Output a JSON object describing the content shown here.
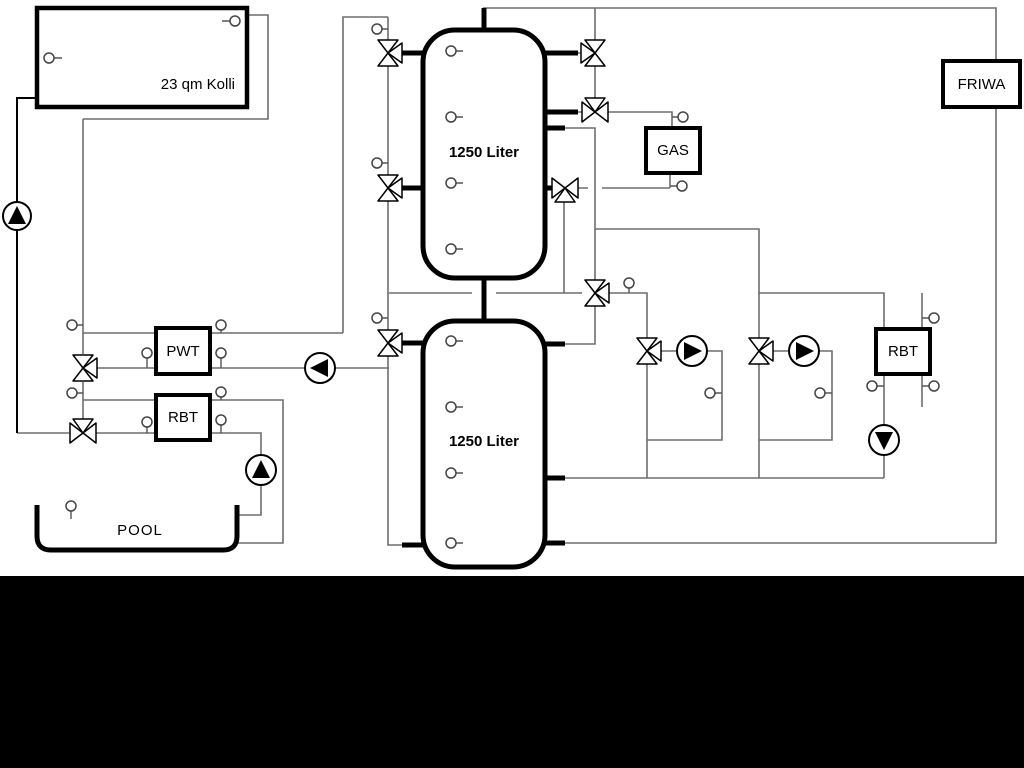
{
  "diagram": {
    "collector_label": "23 qm Kolli",
    "upper_tank_label": "1250 Liter",
    "lower_tank_label": "1250 Liter",
    "pwt_label": "PWT",
    "rbt_left_label": "RBT",
    "gas_label": "GAS",
    "rbt_right_label": "RBT",
    "friwa_label": "FRIWA",
    "pool_label": "POOL",
    "colors": {
      "pipe_gray": "#6e6e6e",
      "pipe_black": "#000000",
      "component_outline": "#000000",
      "background": "#ffffff",
      "footer_bar": "#000000"
    }
  }
}
